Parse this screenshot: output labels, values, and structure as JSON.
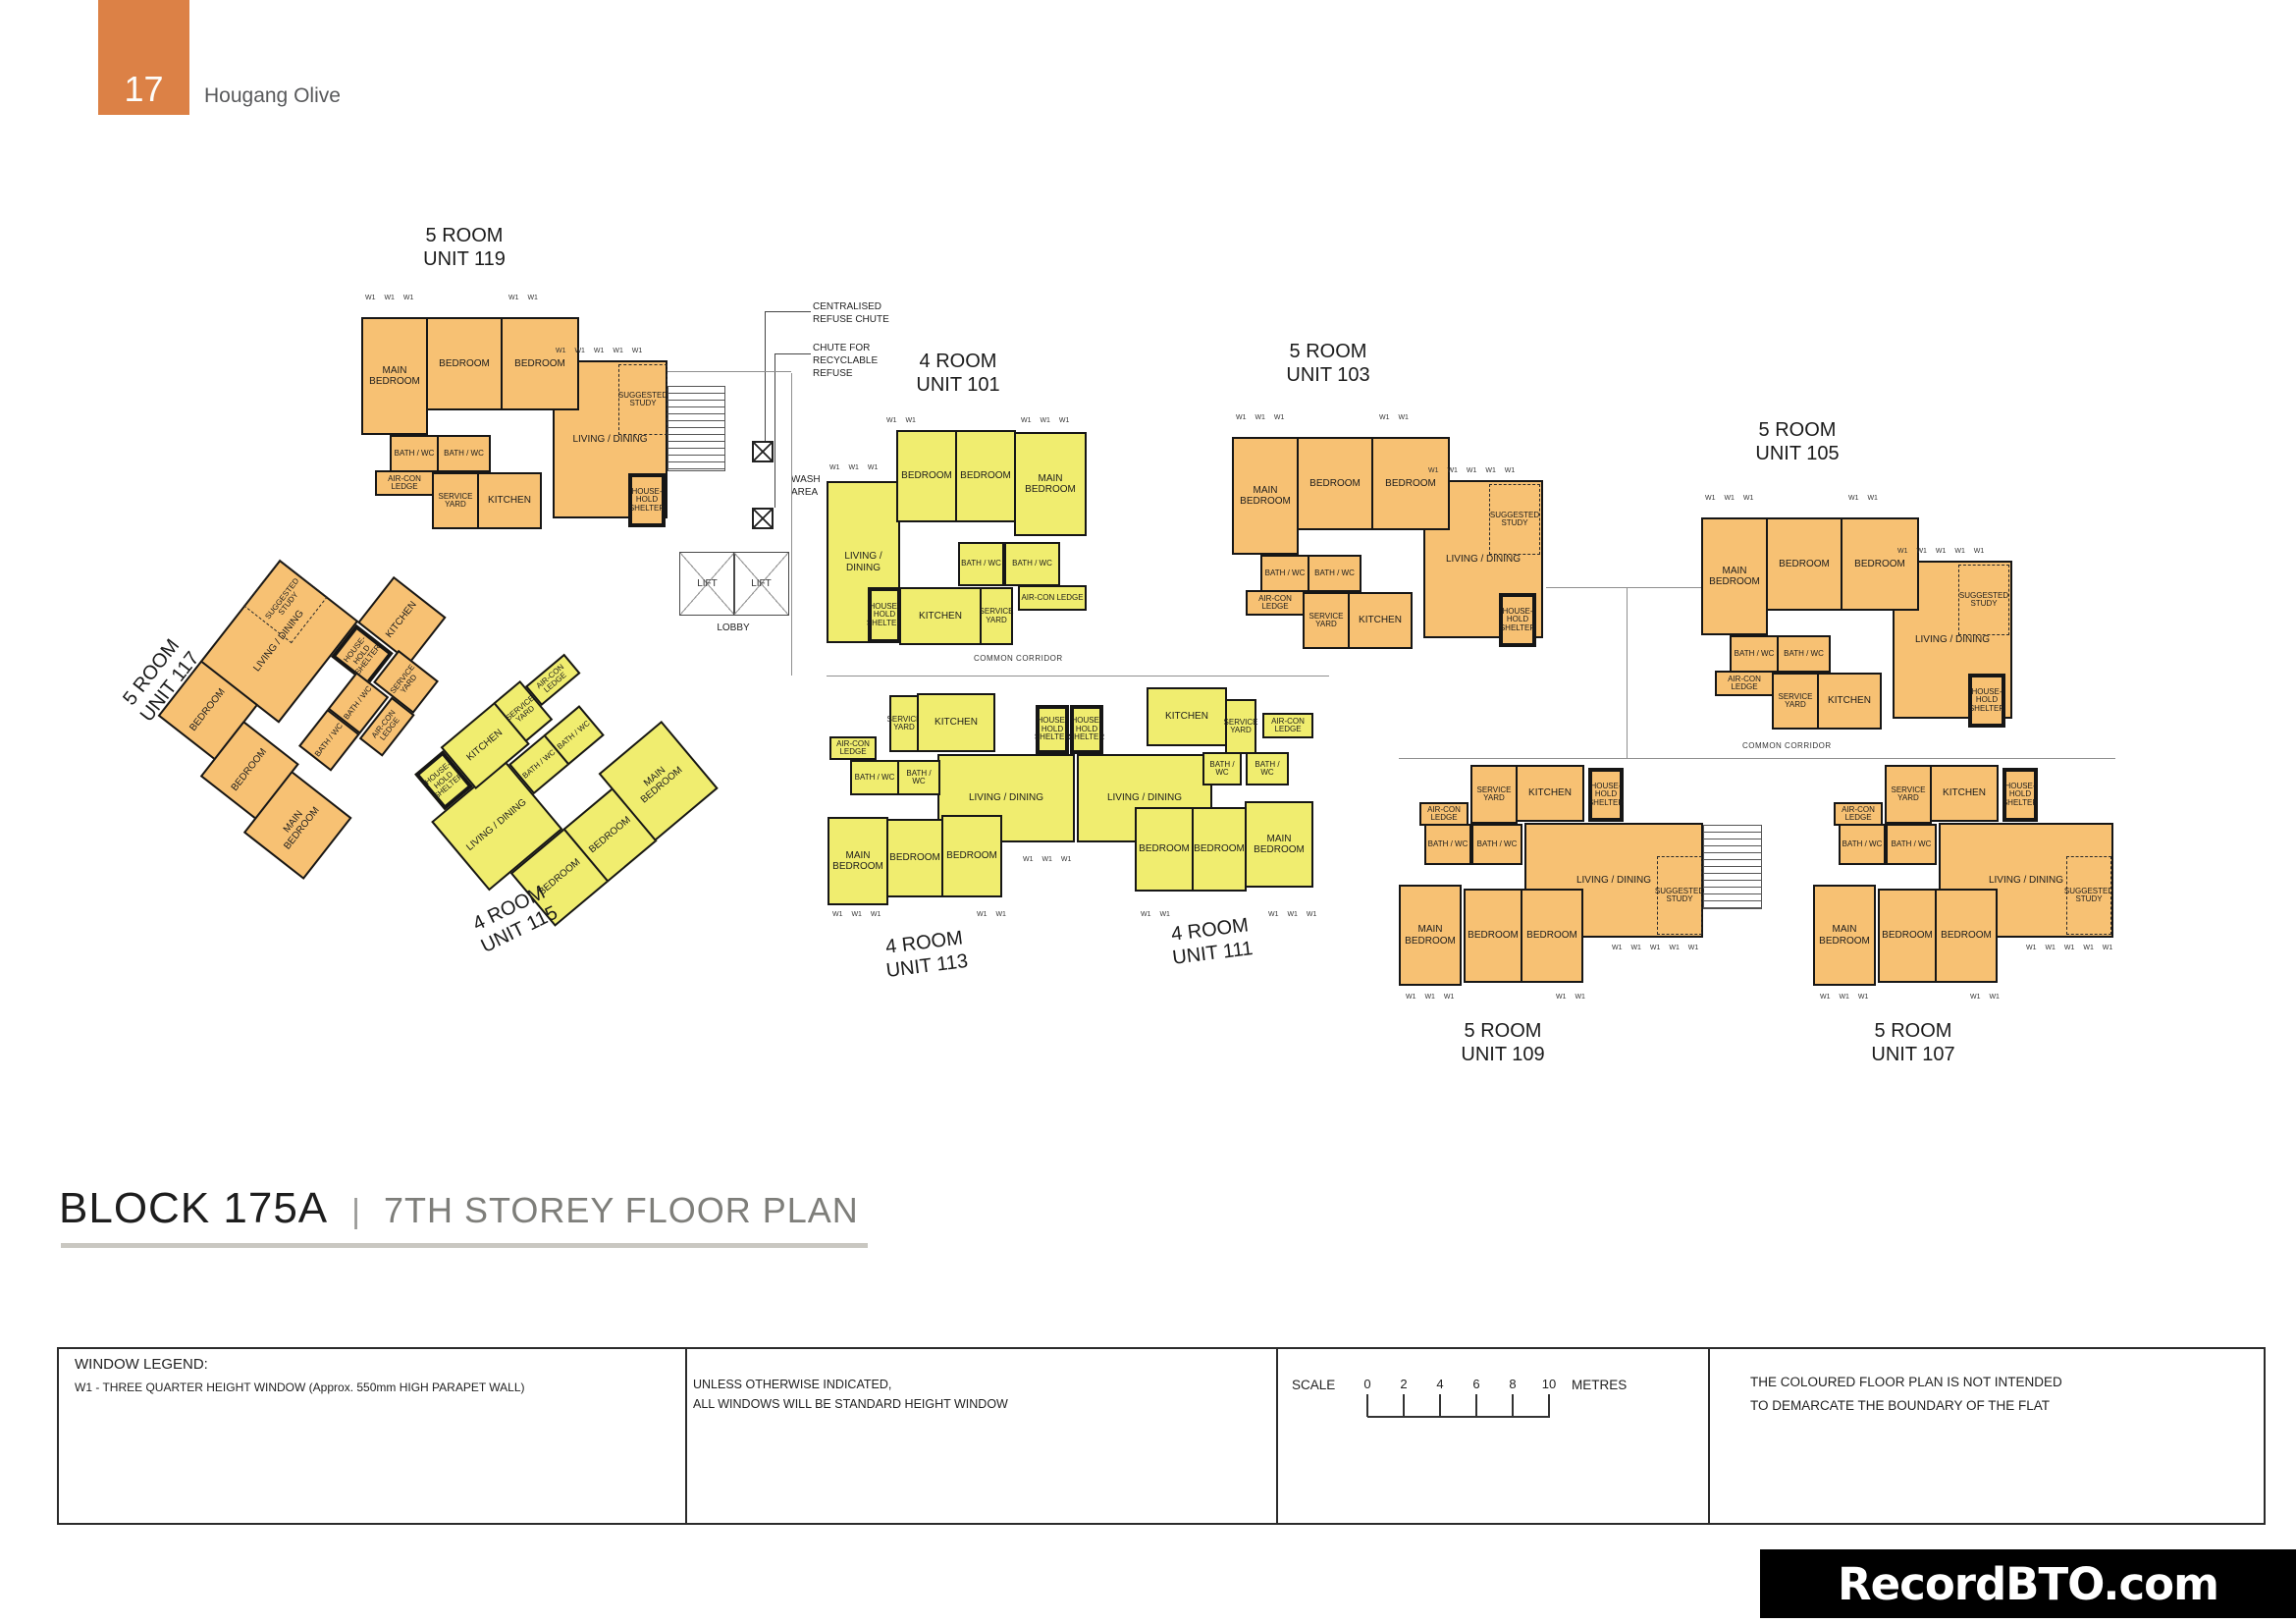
{
  "header": {
    "page_number": "17",
    "project_name": "Hougang Olive"
  },
  "title": {
    "block": "BLOCK 175A",
    "separator": "|",
    "storey": "7TH STOREY FLOOR PLAN"
  },
  "units": {
    "u119": {
      "title": "5 ROOM\nUNIT 119"
    },
    "u101": {
      "title": "4 ROOM\nUNIT 101"
    },
    "u103": {
      "title": "5 ROOM\nUNIT 103"
    },
    "u105": {
      "title": "5 ROOM\nUNIT 105"
    },
    "u117": {
      "title": "5 ROOM\nUNIT 117"
    },
    "u115": {
      "title": "4 ROOM\nUNIT 115"
    },
    "u113": {
      "title": "4 ROOM\nUNIT 113"
    },
    "u111": {
      "title": "4 ROOM\nUNIT 111"
    },
    "u109": {
      "title": "5 ROOM\nUNIT 109"
    },
    "u107": {
      "title": "5 ROOM\nUNIT 107"
    }
  },
  "room_labels": {
    "main_bedroom": "MAIN BEDROOM",
    "bedroom": "BEDROOM",
    "living_dining": "LIVING / DINING",
    "suggested_study": "SUGGESTED STUDY",
    "bath_wc": "BATH / WC",
    "aircon_ledge": "AIR-CON LEDGE",
    "service_yard": "SERVICE YARD",
    "kitchen": "KITCHEN",
    "household_shelter": "HOUSE-HOLD SHELTER"
  },
  "w1": {
    "w2": "W1 W1",
    "w3": "W1 W1 W1",
    "w5": "W1 W1 W1 W1 W1"
  },
  "site": {
    "centralised_chute": "CENTRALISED\nREFUSE CHUTE",
    "recyclable_chute": "CHUTE FOR\nRECYCLABLE\nREFUSE",
    "wash_area": "WASH\nAREA",
    "lobby": "LOBBY",
    "lift": "LIFT",
    "common_corridor": "COMMON CORRIDOR"
  },
  "legend": {
    "heading": "WINDOW LEGEND:",
    "w1_note": "W1 - THREE QUARTER HEIGHT WINDOW (Approx. 550mm HIGH PARAPET WALL)",
    "windows_note_line1": "UNLESS OTHERWISE INDICATED,",
    "windows_note_line2": "ALL WINDOWS WILL BE STANDARD HEIGHT WINDOW",
    "scale_label": "SCALE",
    "scale_ticks": [
      "0",
      "2",
      "4",
      "6",
      "8",
      "10"
    ],
    "scale_unit": "METRES",
    "disclaimer_line1": "THE COLOURED FLOOR PLAN IS NOT INTENDED",
    "disclaimer_line2": "TO DEMARCATE THE BOUNDARY OF THE FLAT"
  },
  "watermark": {
    "text": "RecordBTO.com"
  },
  "colors": {
    "five_room_fill": "#F7C173",
    "four_room_fill": "#F0ED6F",
    "header_tab": "#DC8146"
  }
}
